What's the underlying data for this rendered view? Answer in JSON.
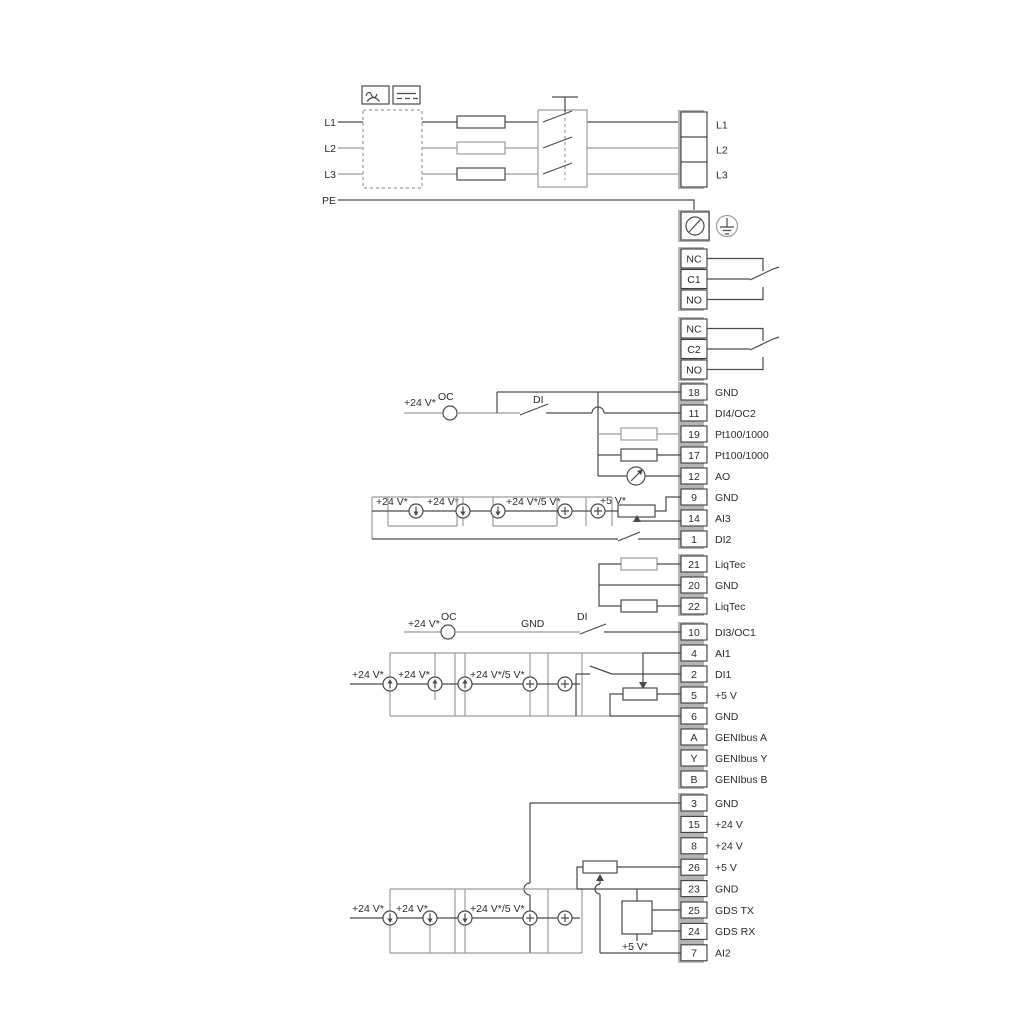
{
  "colors": {
    "wire": "#4a4a4a",
    "gray": "#9c9c9c",
    "spine": "#b4b4b4",
    "text": "#2b2b2b"
  },
  "power": {
    "l1": "L1",
    "l2": "L2",
    "l3": "L3",
    "pe": "PE"
  },
  "terminals": {
    "mains_out": [
      {
        "n": "",
        "l": "L1"
      },
      {
        "n": "",
        "l": "L2"
      },
      {
        "n": "",
        "l": "L3"
      }
    ],
    "relay1": [
      {
        "n": "NC",
        "l": ""
      },
      {
        "n": "C1",
        "l": ""
      },
      {
        "n": "NO",
        "l": ""
      }
    ],
    "relay2": [
      {
        "n": "NC",
        "l": ""
      },
      {
        "n": "C2",
        "l": ""
      },
      {
        "n": "NO",
        "l": ""
      }
    ],
    "io1": [
      {
        "n": "18",
        "l": "GND"
      },
      {
        "n": "11",
        "l": "DI4/OC2"
      },
      {
        "n": "19",
        "l": "Pt100/1000"
      },
      {
        "n": "17",
        "l": "Pt100/1000"
      },
      {
        "n": "12",
        "l": "AO"
      },
      {
        "n": "9",
        "l": "GND"
      },
      {
        "n": "14",
        "l": "AI3"
      },
      {
        "n": "1",
        "l": "DI2"
      }
    ],
    "liqtec": [
      {
        "n": "21",
        "l": "LiqTec"
      },
      {
        "n": "20",
        "l": "GND"
      },
      {
        "n": "22",
        "l": "LiqTec"
      }
    ],
    "io2": [
      {
        "n": "10",
        "l": "DI3/OC1"
      },
      {
        "n": "4",
        "l": "AI1"
      },
      {
        "n": "2",
        "l": "DI1"
      },
      {
        "n": "5",
        "l": "+5 V"
      },
      {
        "n": "6",
        "l": "GND"
      },
      {
        "n": "A",
        "l": "GENIbus A"
      },
      {
        "n": "Y",
        "l": "GENIbus Y"
      },
      {
        "n": "B",
        "l": "GENIbus B"
      }
    ],
    "io3": [
      {
        "n": "3",
        "l": "GND"
      },
      {
        "n": "15",
        "l": "+24 V"
      },
      {
        "n": "8",
        "l": "+24 V"
      },
      {
        "n": "26",
        "l": "+5 V"
      },
      {
        "n": "23",
        "l": "GND"
      },
      {
        "n": "25",
        "l": "GDS TX"
      },
      {
        "n": "24",
        "l": "GDS RX"
      },
      {
        "n": "7",
        "l": "AI2"
      }
    ]
  },
  "labels": {
    "row11": {
      "v24": "+24 V*",
      "oc": "OC",
      "di": "DI"
    },
    "row10": {
      "v24": "+24 V*",
      "oc": "OC",
      "gnd": "GND",
      "di": "DI"
    },
    "ai3": {
      "v24a": "+24 V*",
      "v24b": "+24 V*",
      "v245": "+24 V*/5 V*",
      "v5": "+5 V*"
    },
    "ai1": {
      "v24a": "+24 V*",
      "v24b": "+24 V*",
      "v245": "+24 V*/5 V*"
    },
    "ai2": {
      "v24a": "+24 V*",
      "v24b": "+24 V*",
      "v245": "+24 V*/5 V*",
      "v5": "+5 V*"
    }
  }
}
